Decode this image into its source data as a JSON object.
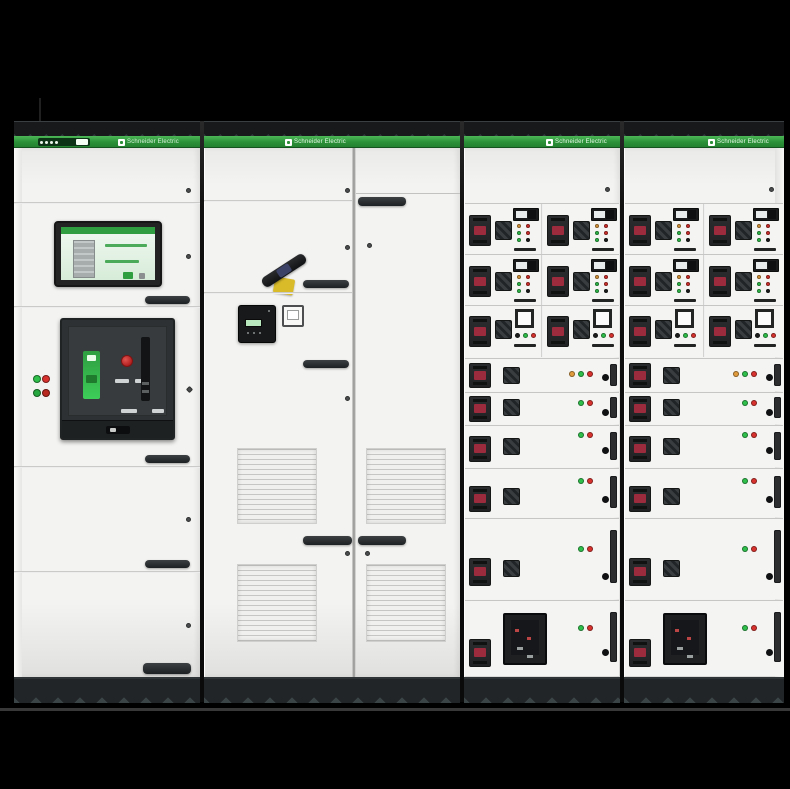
{
  "scene": {
    "background": "#000000",
    "floor_line_color": "#383838"
  },
  "palette": {
    "green_band_top": "#4cb857",
    "green_band_bottom": "#23812f",
    "cabinet_white": "#f3f3f1",
    "trim_dark": "#17191b",
    "trim_accent": "#31383a",
    "plinth_dark": "#212527",
    "plinth_accent": "#3a4346",
    "led_green": "#2fbf4a",
    "led_red": "#d8322e",
    "led_orange": "#e09b3c",
    "led_off": "#1c1e1e",
    "label_red": "#9c2b3d",
    "component_dark": "#26282a",
    "acb_green": "#3dcd58",
    "acb_red_button": "#c82b28",
    "rotary_yellow": "#d9bb2a"
  },
  "branding": {
    "logo_text": "Schneider Electric"
  },
  "cabinets": [
    {
      "name": "incoming-section"
    },
    {
      "name": "coupling-section"
    },
    {
      "name": "mcc-drawer-section-1"
    },
    {
      "name": "mcc-drawer-section-2"
    }
  ],
  "mcc": {
    "screw_y": 39,
    "small_rows": [
      {
        "top": 55,
        "h": 51,
        "type": "A"
      },
      {
        "top": 106,
        "h": 51,
        "type": "A"
      },
      {
        "top": 157,
        "h": 52,
        "type": "B"
      }
    ],
    "wide_rows": [
      {
        "top": 210,
        "h": 33,
        "leds": [
          "orange",
          "green",
          "red"
        ],
        "led_y": 12,
        "handle_y": 4,
        "handle_h": 25,
        "switch_y": 8,
        "latch_y": 15
      },
      {
        "top": 244,
        "h": 32,
        "leds": [
          "green",
          "red"
        ],
        "led_y": 7,
        "handle_y": 3,
        "handle_h": 26,
        "switch_y": 6,
        "latch_y": 16
      },
      {
        "top": 277,
        "h": 42,
        "leds": [
          "green",
          "red"
        ],
        "led_y": 6,
        "handle_y": 10,
        "handle_h": 26,
        "switch_y": 12,
        "latch_y": 21
      },
      {
        "top": 320,
        "h": 49,
        "leds": [
          "green",
          "red"
        ],
        "led_y": 9,
        "handle_y": 17,
        "handle_h": 26,
        "switch_y": 19,
        "latch_y": 27
      },
      {
        "top": 370,
        "h": 81,
        "leds": [
          "green",
          "red"
        ],
        "led_y": 27,
        "handle_y": 39,
        "handle_h": 28,
        "switch_y": 41,
        "latch_y": 54
      },
      {
        "top": 452,
        "h": 76,
        "leds": [
          "green",
          "red"
        ],
        "led_y": 24,
        "handle_y": 38,
        "handle_h": 28,
        "switch_y": -1,
        "latch_y": 48,
        "display": true
      }
    ]
  }
}
